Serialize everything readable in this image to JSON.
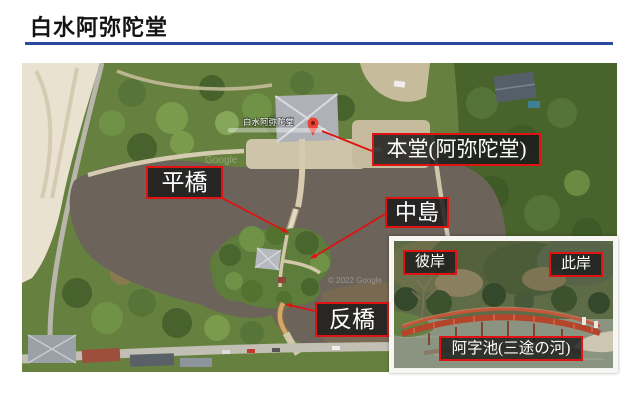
{
  "slide": {
    "title": "白水阿弥陀堂"
  },
  "aerial": {
    "marker_label": "白水阿弥陀堂",
    "watermark_center": "Google",
    "watermark_bottom": "© 2022 Google",
    "labels": {
      "hondo": "本堂(阿弥陀堂)",
      "hirabashi": "平橋",
      "nakajima": "中島",
      "soribashi": "反橋"
    }
  },
  "inset": {
    "labels": {
      "higan": "彼岸",
      "shigan": "此岸",
      "pond": "阿字池(三途の河)"
    }
  },
  "colors": {
    "annotation_red": "#e01212",
    "title_rule_blue": "#2a4a9d",
    "label_background": "rgba(26,26,26,0.84)"
  }
}
